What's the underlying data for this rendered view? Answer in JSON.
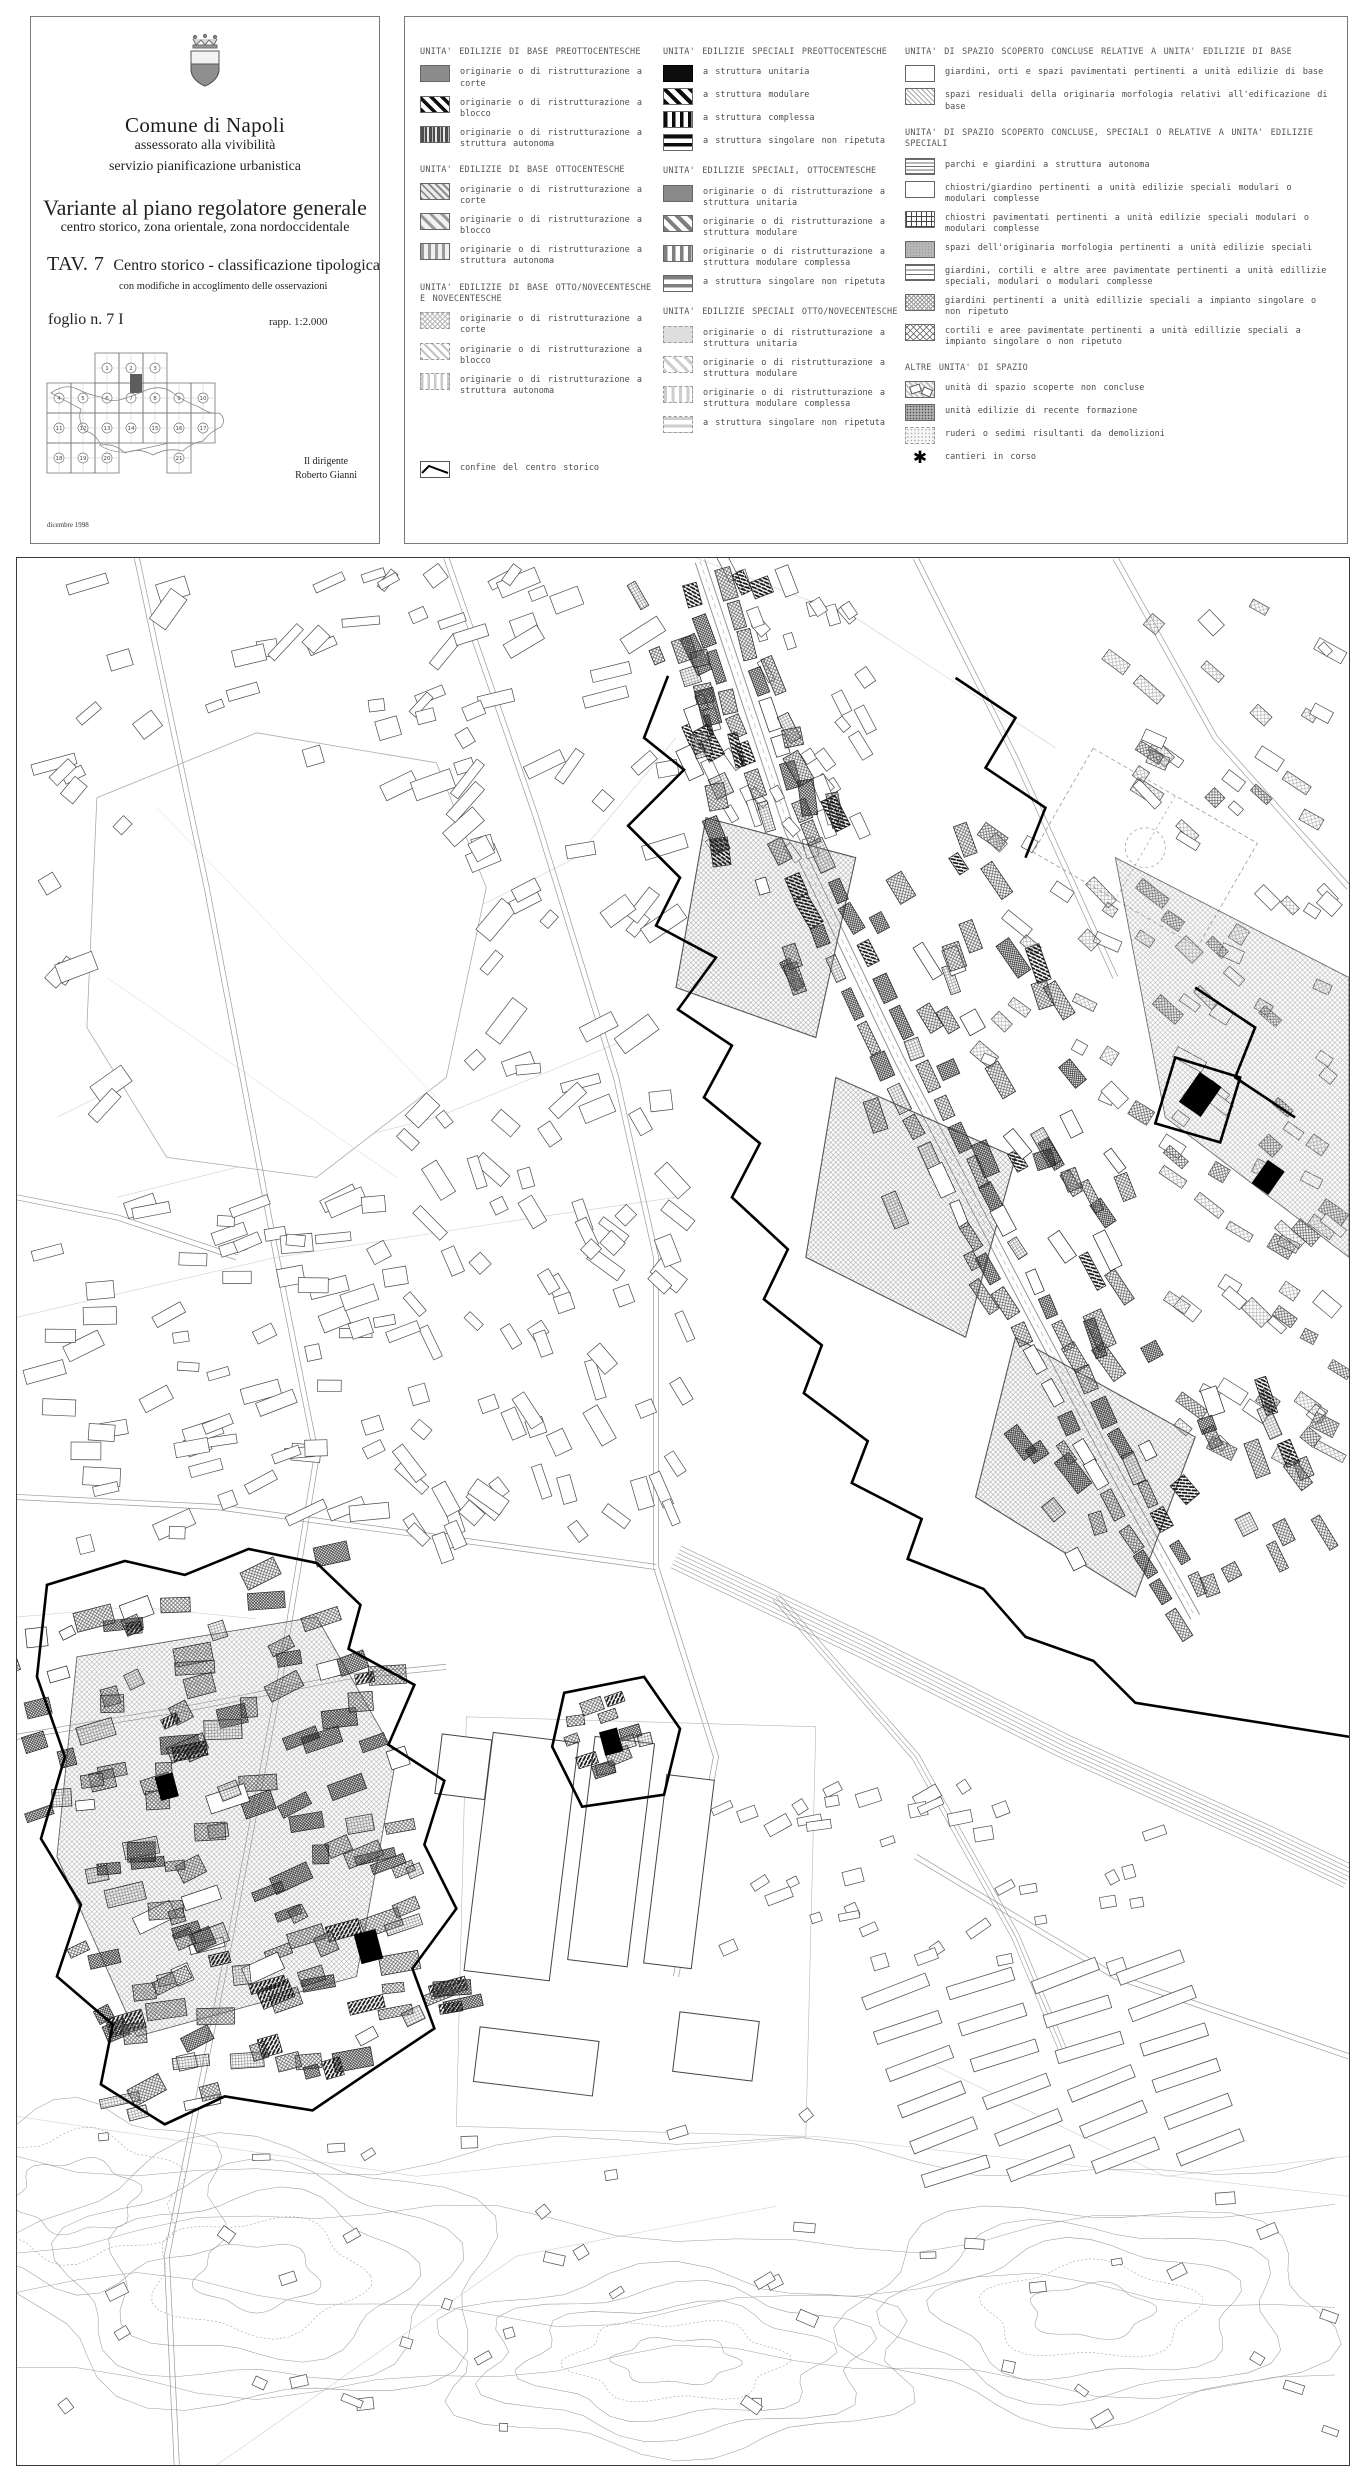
{
  "title_block": {
    "municipality": "Comune di Napoli",
    "department": "assessorato alla vivibilità",
    "office": "servizio pianificazione urbanistica",
    "plan_title": "Variante al piano regolatore generale",
    "plan_subtitle": "centro storico, zona orientale, zona nordoccidentale",
    "sheet_label": "TAV. 7",
    "sheet_title": "Centro storico - classificazione tipologica",
    "sheet_note": "con modifiche in accoglimento delle osservazioni",
    "folio": "foglio n. 7 I",
    "scale": "rapp. 1:2.000",
    "signature_role": "Il dirigente",
    "signature_name": "Roberto Gianni",
    "date": "dicembre 1998",
    "index_map": {
      "highlighted_sheet": "7 I",
      "rows": [
        {
          "cells": [
            {
              "col": 2,
              "n": "1"
            },
            {
              "col": 3,
              "n": "2"
            },
            {
              "col": 4,
              "n": "3"
            }
          ]
        },
        {
          "cells": [
            {
              "col": 0,
              "n": "4"
            },
            {
              "col": 1,
              "n": "5"
            },
            {
              "col": 2,
              "n": "6"
            },
            {
              "col": 3,
              "n": "7"
            },
            {
              "col": 4,
              "n": "8"
            },
            {
              "col": 5,
              "n": "9"
            },
            {
              "col": 6,
              "n": "10"
            }
          ]
        },
        {
          "cells": [
            {
              "col": 0,
              "n": "11"
            },
            {
              "col": 1,
              "n": "12"
            },
            {
              "col": 2,
              "n": "13"
            },
            {
              "col": 3,
              "n": "14"
            },
            {
              "col": 4,
              "n": "15"
            },
            {
              "col": 5,
              "n": "16"
            },
            {
              "col": 6,
              "n": "17"
            }
          ]
        },
        {
          "cells": [
            {
              "col": 0,
              "n": "18"
            },
            {
              "col": 1,
              "n": "19"
            },
            {
              "col": 2,
              "n": "20"
            },
            {
              "col": 5,
              "n": "21"
            }
          ]
        }
      ]
    }
  },
  "legend": {
    "columns": [
      {
        "groups": [
          {
            "title": "UNITA' EDILIZIE DI BASE PREOTTOCENTESCHE",
            "items": [
              {
                "swatch": "crosshatch-dark-gray",
                "label": "originarie o di ristrutturazione a corte"
              },
              {
                "swatch": "diagonal-black",
                "label": "originarie o di ristrutturazione a blocco"
              },
              {
                "swatch": "vertical-dark-gray",
                "label": "originarie o di ristrutturazione a struttura autonoma"
              }
            ]
          },
          {
            "title": "UNITA' EDILIZIE DI BASE OTTOCENTESCHE",
            "items": [
              {
                "swatch": "diagonal-fine-gray",
                "label": "originarie o di ristrutturazione a corte"
              },
              {
                "swatch": "diagonal-gray",
                "label": "originarie o di ristrutturazione a blocco"
              },
              {
                "swatch": "vertical-gray",
                "label": "originarie o di ristrutturazione a struttura autonoma"
              }
            ]
          },
          {
            "title": "UNITA' EDILIZIE DI BASE OTTO/NOVECENTESCHE E NOVECENTESCHE",
            "items": [
              {
                "swatch": "crosshatch-light",
                "label": "originarie o di ristrutturazione a corte"
              },
              {
                "swatch": "diagonal-light",
                "label": "originarie o di ristrutturazione a blocco"
              },
              {
                "swatch": "vertical-light",
                "label": "originarie o di ristrutturazione a struttura autonoma"
              }
            ]
          }
        ]
      },
      {
        "groups": [
          {
            "title": "UNITA' EDILIZIE SPECIALI PREOTTOCENTESCHE",
            "items": [
              {
                "swatch": "solid-black",
                "label": "a struttura unitaria"
              },
              {
                "swatch": "diagonal-black-bold",
                "label": "a struttura modulare"
              },
              {
                "swatch": "vertical-black",
                "label": "a struttura complessa"
              },
              {
                "swatch": "horizontal-black",
                "label": "a struttura singolare non ripetuta"
              }
            ]
          },
          {
            "title": "UNITA' EDILIZIE SPECIALI, OTTOCENTESCHE",
            "items": [
              {
                "swatch": "solid-gray",
                "label": "originarie o di ristrutturazione a struttura unitaria"
              },
              {
                "swatch": "diagonal-gray-bold",
                "label": "originarie o di ristrutturazione a struttura modulare"
              },
              {
                "swatch": "vertical-gray-bold",
                "label": "originarie o di ristrutturazione a struttura modulare complessa"
              },
              {
                "swatch": "horizontal-gray",
                "label": "a struttura singolare non ripetuta"
              }
            ]
          },
          {
            "title": "UNITA' EDILIZIE SPECIALI OTTO/NOVECENTESCHE",
            "items": [
              {
                "swatch": "solid-light",
                "label": "originarie o di ristrutturazione a struttura unitaria"
              },
              {
                "swatch": "diagonal-light-dashed",
                "label": "originarie o di ristrutturazione a struttura modulare"
              },
              {
                "swatch": "vertical-light-dashed",
                "label": "originarie o di ristrutturazione a struttura modulare complessa"
              },
              {
                "swatch": "horizontal-light-dashed",
                "label": "a struttura singolare non ripetuta"
              }
            ]
          }
        ]
      },
      {
        "groups": [
          {
            "title": "UNITA' DI SPAZIO SCOPERTO CONCLUSE RELATIVE A UNITA' EDILIZIE DI BASE",
            "items": [
              {
                "swatch": "grid-fine",
                "label": "giardini, orti e spazi pavimentati pertinenti a unità edilizie di base"
              },
              {
                "swatch": "diagonal-fine-light",
                "label": "spazi residuali della originaria morfologia relativi all'edificazione di base"
              }
            ]
          },
          {
            "title": "UNITA' DI SPAZIO SCOPERTO CONCLUSE, SPECIALI O RELATIVE A UNITA' EDILIZIE SPECIALI",
            "items": [
              {
                "swatch": "hlines-fine",
                "label": "parchi e giardini a struttura autonoma"
              },
              {
                "swatch": "grid-dense-gray",
                "label": "chiostri/giardino pertinenti a unità edilizie speciali modulari o modulari complesse"
              },
              {
                "swatch": "grid-open",
                "label": "chiostri pavimentati pertinenti a unità edilizie speciali modulari o modulari complesse"
              },
              {
                "swatch": "texture-gray",
                "label": "spazi dell'originaria morfologia pertinenti a unità edilizie speciali"
              },
              {
                "swatch": "hlines-wide",
                "label": "giardini, cortili e altre aree pavimentate pertinenti a unità edillizie speciali, modulari o modulari complesse"
              },
              {
                "swatch": "diamond-fine",
                "label": "giardini pertinenti a unità edillizie speciali a impianto singolare o non ripetuto"
              },
              {
                "swatch": "diamond-open",
                "label": "cortili e aree pavimentate pertinenti a unità edillizie speciali a impianto singolare o non ripetuto"
              }
            ]
          },
          {
            "title": "ALTRE UNITA' DI SPAZIO",
            "items": [
              {
                "swatch": "map-sketch",
                "label": "unità di spazio scoperte non concluse"
              },
              {
                "swatch": "dots-dense-gray",
                "label": "unità edilizie di recente formazione"
              },
              {
                "swatch": "dots-light",
                "label": "ruderi o sedimi risultanti da demolizioni"
              },
              {
                "swatch": "asterisk",
                "label": "cantieri in corso"
              }
            ]
          }
        ]
      }
    ],
    "boundary": {
      "swatch": "boundary-line",
      "label": "confine del centro storico"
    }
  }
}
